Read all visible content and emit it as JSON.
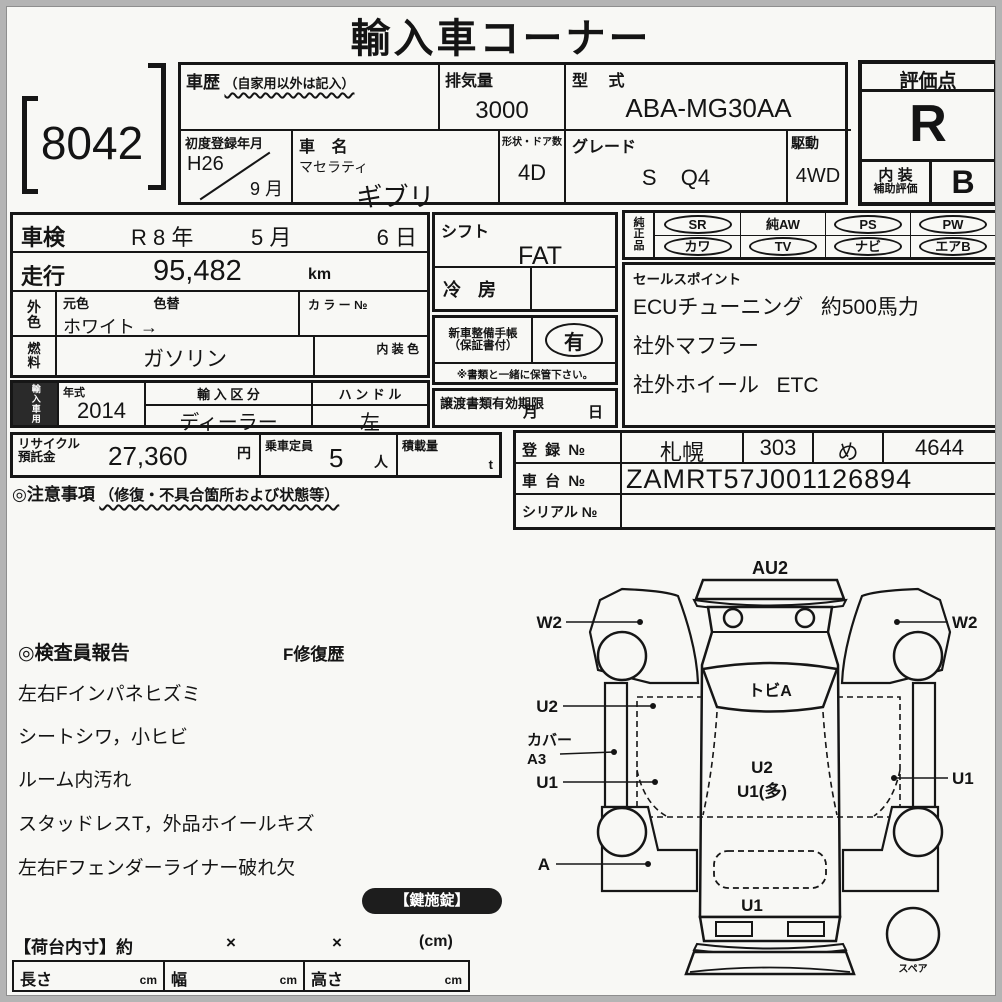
{
  "page": {
    "title": "輸入車コーナー",
    "lot_number": "8042"
  },
  "header": {
    "history_label": "車歴",
    "history_note": "（自家用以外は記入）",
    "displacement_label": "排気量",
    "displacement_value": "3000",
    "model_label": "型 式",
    "model_value": "ABA-MG30AA",
    "first_reg_label": "初度登録年月",
    "first_reg_year": "H26",
    "first_reg_month": "9 月",
    "name_label": "車 名",
    "maker": "マセラティ",
    "model_name": "ギブリ",
    "doors_label": "形状・ドア数",
    "doors_value": "4D",
    "grade_label": "グレード",
    "grade_value": "S Q4",
    "drive_label": "駆動",
    "drive_value": "4WD"
  },
  "evaluation": {
    "label": "評価点",
    "score": "R",
    "interior_label1": "内 装",
    "interior_label2": "補助評価",
    "interior_score": "B"
  },
  "left": {
    "shaken_label": "車検",
    "shaken_year": "R 8 年",
    "shaken_month": "5 月",
    "shaken_day": "6 日",
    "mileage_label": "走行",
    "mileage_value": "95,482",
    "mileage_unit": "km",
    "color_label1": "外",
    "color_label2": "色",
    "color_orig_label": "元色",
    "color_change_label": "色替",
    "color_value": "ホワイト →",
    "color_no_label": "カ ラ ー №",
    "fuel_label1": "燃",
    "fuel_label2": "料",
    "fuel_value": "ガソリン",
    "interior_color_label": "内 装 色",
    "import_label": "輸入車用",
    "year_label": "年式",
    "year_value": "2014",
    "route_label": "輸 入 区 分",
    "route_value": "ディーラー",
    "handle_label": "ハ ン ド ル",
    "handle_value": "左"
  },
  "middle": {
    "shift_label": "シフト",
    "shift_value": "FAT",
    "aircon_label": "冷 房",
    "book_label1": "新車整備手帳",
    "book_label2": "（保証書付）",
    "book_value": "有",
    "book_note": "※書類と一緒に保管下さい。",
    "transfer_label": "譲渡書類有効期限",
    "transfer_month": "月",
    "transfer_day": "日"
  },
  "equipment": {
    "label1": "純",
    "label2": "正",
    "label3": "品",
    "items": [
      {
        "name": "SR",
        "circled": true
      },
      {
        "name": "純AW",
        "circled": false
      },
      {
        "name": "PS",
        "circled": true
      },
      {
        "name": "PW",
        "circled": true
      },
      {
        "name": "カワ",
        "circled": true
      },
      {
        "name": "TV",
        "circled": true
      },
      {
        "name": "ナビ",
        "circled": true
      },
      {
        "name": "エアB",
        "circled": true
      }
    ]
  },
  "sales": {
    "label": "セールスポイント",
    "lines": [
      "ECUチューニング   約500馬力",
      "社外マフラー",
      "社外ホイール   ETC"
    ]
  },
  "recycle_row": {
    "recycle_label1": "リサイクル",
    "recycle_label2": "預託金",
    "recycle_value": "27,360",
    "recycle_unit": "円",
    "capacity_label": "乗車定員",
    "capacity_value": "5",
    "capacity_unit": "人",
    "load_label": "積載量",
    "load_unit": "t"
  },
  "caution": {
    "title": "◎注意事項",
    "note": "（修復・不具合箇所および状態等）"
  },
  "registration": {
    "reg_label": "登 録 №",
    "reg_area": "札幌",
    "reg_class": "303",
    "reg_kana": "め",
    "reg_number": "4644",
    "chassis_label": "車 台 №",
    "chassis_value": "ZAMRT57J001126894",
    "serial_label": "シリアル №",
    "serial_value": ""
  },
  "report": {
    "title": "◎検査員報告",
    "repair": "F修復歴",
    "lines": [
      "左右Fインパネヒズミ",
      "シートシワ，小ヒビ",
      "ルーム内汚れ",
      "スタッドレスT，外品ホイールキズ",
      "左右Fフェンダーライナー破れ欠"
    ]
  },
  "diagram": {
    "au2": "AU2",
    "w2_left": "W2",
    "w2_right": "W2",
    "windshield": "トビA",
    "u2_left": "U2",
    "cover1": "カバー",
    "cover2": "A3",
    "u1_left": "U1",
    "u1_right": "U1",
    "center1": "U2",
    "center2": "U1(多)",
    "a_left": "A",
    "u1_rear": "U1",
    "spare": "スペア"
  },
  "footer": {
    "key_badge": "【鍵施錠】",
    "cargo_label": "【荷台内寸】約",
    "x1": "×",
    "x2": "×",
    "unit": "(cm)",
    "len_label": "長さ",
    "wid_label": "幅",
    "hei_label": "高さ",
    "cm": "cm"
  }
}
